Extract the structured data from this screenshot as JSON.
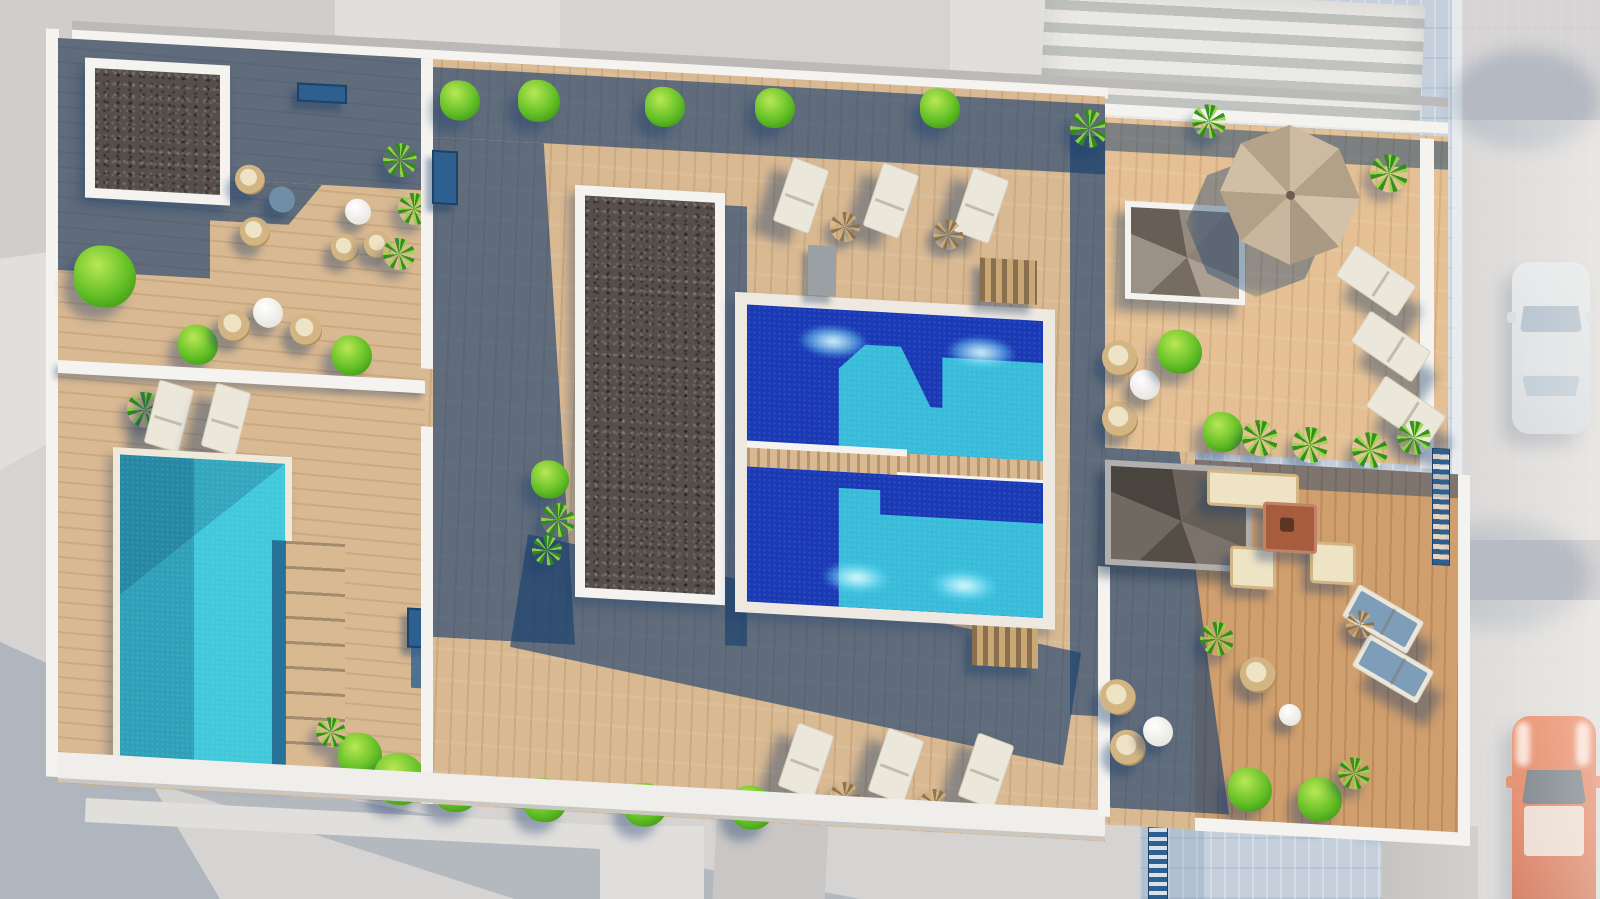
{
  "scene": {
    "type": "architectural-3d-render",
    "view": "top-down aerial",
    "subject": "residential rooftop terrace complex with swimming pools",
    "areas": {
      "left_terrace": {
        "features": [
          "gravel roof square",
          "lounge furniture",
          "teal private pool",
          "wood deck stairs"
        ]
      },
      "central_terrace": {
        "features": [
          "long gravel roof strip",
          "two communal pools with underwater lights",
          "sun lounger rows",
          "hedge planters"
        ]
      },
      "right_terrace": {
        "features": [
          "two spiral staircases",
          "large canvas parasol",
          "outdoor sofa set with fire table",
          "hanging wicker chairs",
          "sun loungers"
        ]
      },
      "street": {
        "features": [
          "pedestrian crossing",
          "paved sidewalk",
          "parked white car",
          "parked orange car"
        ]
      }
    },
    "object_counts": {
      "pools": 3,
      "gravel_roofs": 2,
      "spiral_stairs": 2,
      "parasols": 1,
      "sun_loungers": 13,
      "wicker_chairs": 12,
      "round_tables": 7,
      "sofa_sets": 1,
      "cars": 2,
      "bushes": 22,
      "palms": 18
    }
  },
  "palette": {
    "street": "#d6d4d2",
    "street_dark": "#d0cecd",
    "street_light": "#e1dfdc",
    "paver": "#c5d0dc",
    "curb": "#eef0f1",
    "warm_street": "#d8d5d2",
    "cross_light": "#ebe9e5",
    "cross_dark": "#c0c3c0",
    "wall": "#f4f3f0",
    "wall_gray": "#bcbab8",
    "wood": "#d9b992",
    "wood_red": "#cf9f6e",
    "deckshadow": "rgba(21,62,110,0.62)",
    "gravel": "#554e49",
    "teal_light": "#41c8da",
    "teal_dark": "rgba(10,70,110,0.30)",
    "pool_deep": "#1a39b5",
    "pool_cyan": "#38bcd9",
    "green_hi": "#b8e855",
    "green": "#63bf26",
    "green_dk": "#3a9315",
    "lounger": "#ece7db",
    "cushion": "#7e9db9",
    "wicker": "#d3b584",
    "wicker_hi": "#efe3c6",
    "table_w": "#e8e6e0",
    "table_b": "#6f8fa6",
    "fixture": "#2d5f91",
    "umbrella_a": "#cdbaa2",
    "umbrella_b": "#b2a088",
    "car_pale": "#dfe3e8",
    "car_pale_glass": "#9fb1c4",
    "car_orange": "#d9603a",
    "car_glass": "#4e5a67",
    "terracotta": "#a85c3e"
  }
}
